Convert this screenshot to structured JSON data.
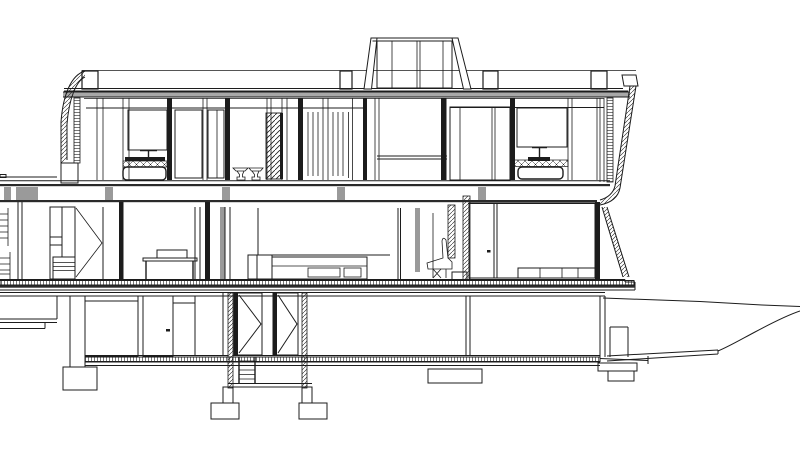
{
  "drawing": {
    "type": "architectural-section",
    "view": "transverse building section of a two-storey modernist house with basement, rooftop clerestory and hillside terrain falling away to the right",
    "style": "black CAD line drawing on white",
    "colors": {
      "background": "#ffffff",
      "ink": "#1c1c1c",
      "cut_wall_fill": "#111111",
      "beam_fill": "#9a9a9a",
      "fascia_fill": "#a8a8a8"
    },
    "levels": [
      "rooftop-clerestory",
      "roof",
      "upper-floor",
      "ground-floor",
      "basement",
      "foundations",
      "site-terrain"
    ],
    "structure": {
      "clerestory": "glazed rooftop monitor with outward-sloping end mullions",
      "roof": "flat roof slab with railing line, four parapet upstand blocks, curved hatched fascia at left, sloped hatched fascia at right",
      "upper_floor": {
        "rooms": [
          {
            "name": "bathroom-left",
            "fixtures": [
              "mirror",
              "faucet",
              "vanity-counter",
              "basin-edge",
              "bathtub"
            ]
          },
          {
            "name": "wc-room",
            "fixtures": [
              "toilet",
              "bidet"
            ]
          },
          {
            "name": "louver-shaft",
            "fixtures": [
              "louvered-panel"
            ]
          },
          {
            "name": "slatted-screens"
          },
          {
            "name": "double-height-void",
            "fixtures": [
              "guardrail-lines"
            ]
          },
          {
            "name": "wardrobe"
          },
          {
            "name": "bathroom-right",
            "fixtures": [
              "mirror",
              "faucet",
              "vanity-counter",
              "basin-edge",
              "bathtub"
            ]
          }
        ]
      },
      "ground_floor": {
        "rooms": [
          {
            "name": "left-wing",
            "fixtures": [
              "bookshelf",
              "wardrobe-with-dresser",
              "open-door-leaf"
            ]
          },
          {
            "name": "living-area",
            "fixtures": [
              "desk-with-seat",
              "sofa-with-side-table"
            ]
          },
          {
            "name": "fireplace-zone",
            "fixtures": [
              "flue",
              "hearth",
              "lounge-chair"
            ]
          },
          {
            "name": "glazed-bay",
            "fixtures": [
              "window-wall",
              "sill-cabinets"
            ]
          }
        ]
      },
      "basement": {
        "rooms": [
          {
            "name": "left-rooms",
            "fixtures": [
              "window",
              "door-with-handle"
            ]
          },
          {
            "name": "stairwell",
            "fixtures": [
              "bifold-door-leaf-left",
              "bifold-door-leaf-right",
              "ship-ladder"
            ]
          },
          {
            "name": "right-room",
            "fixtures": [
              "window-well"
            ]
          }
        ]
      },
      "foundations": "concrete piers on spread footings under walls and stairwell",
      "site": "ground line running off to the right edge with stepped path and falling slope"
    }
  }
}
